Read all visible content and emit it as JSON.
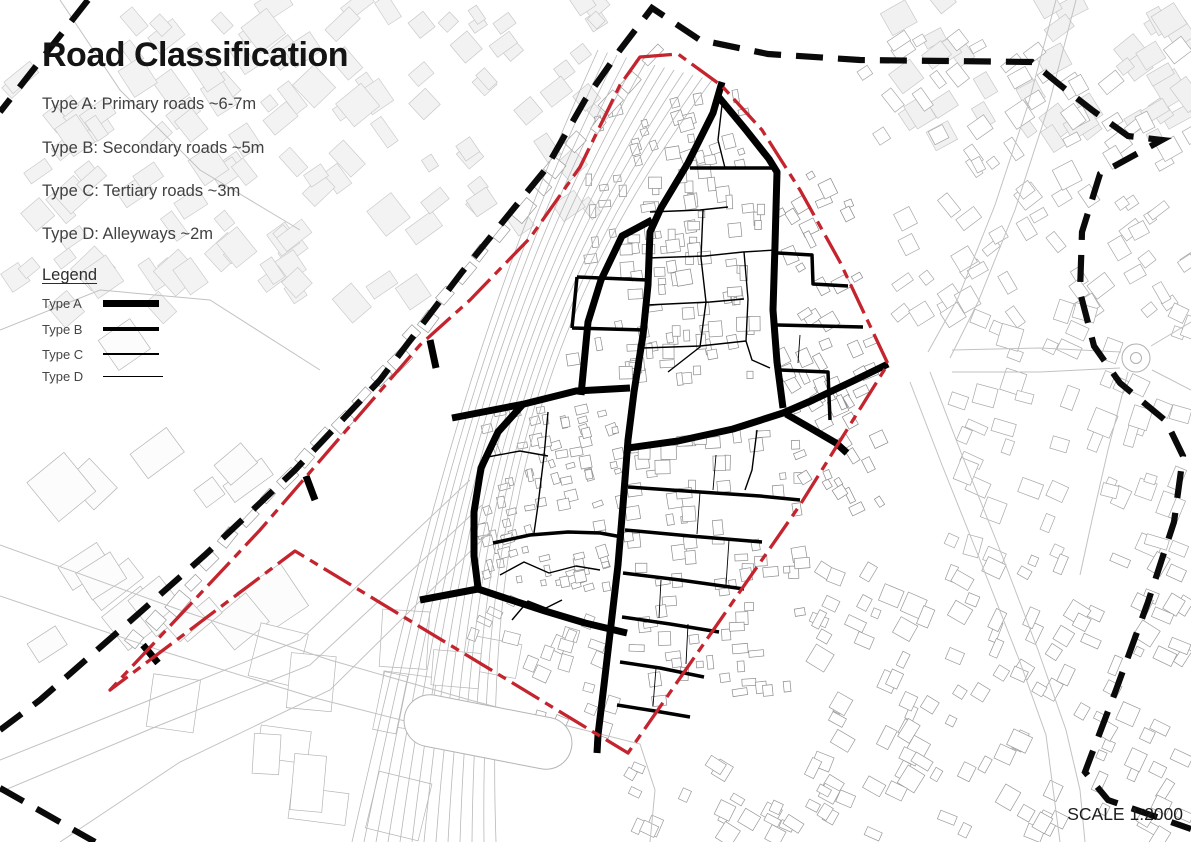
{
  "header": {
    "title": "Road Classification"
  },
  "classification": {
    "items": [
      {
        "label": "Type A: Primary roads ~6-7m"
      },
      {
        "label": "Type B: Secondary roads ~5m"
      },
      {
        "label": "Type C: Tertiary roads ~3m"
      },
      {
        "label": "Type D: Alleyways ~2m"
      }
    ]
  },
  "legend": {
    "title": "Legend",
    "items": [
      {
        "label": "Type A",
        "class": "lw-a"
      },
      {
        "label": "Type B",
        "class": "lw-b"
      },
      {
        "label": "Type C",
        "class": "lw-c"
      },
      {
        "label": "Type D",
        "class": "lw-d"
      }
    ]
  },
  "scale_note": "SCALE 1:2000",
  "colors": {
    "site_boundary_red": "#c4242d",
    "outer_boundary_black": "#0a0a0a",
    "road_black": "#000000",
    "building_stroke": "#a0a0a0",
    "building_light_fill": "#f2f2f2",
    "rail_gray": "#b8b8b8",
    "street_gray": "#c2c2c2"
  },
  "map": {
    "width": 1191,
    "height": 842,
    "site_boundary": {
      "style": "dash-dot",
      "width": 3.3,
      "dash": "32 7 9 7",
      "points": [
        640,
        57,
        678,
        54,
        722,
        86,
        762,
        130,
        800,
        190,
        840,
        262,
        888,
        364,
        800,
        505,
        628,
        753,
        295,
        551,
        110,
        690,
        260,
        530,
        420,
        345,
        470,
        300,
        530,
        238,
        580,
        167,
        620,
        85
      ]
    },
    "outer_boundary": {
      "style": "dashed",
      "width": 6.2,
      "dash": "27 15",
      "segments": [
        [
          88,
          0,
          0,
          112
        ],
        [
          0,
          730,
          40,
          700,
          120,
          630,
          205,
          555,
          295,
          470,
          380,
          380,
          462,
          272,
          545,
          170,
          585,
          100,
          620,
          50,
          652,
          8,
          700,
          40,
          768,
          54,
          860,
          60,
          1032,
          62,
          1060,
          85,
          1092,
          110,
          1128,
          136,
          1162,
          140,
          1100,
          174,
          1082,
          232,
          1080,
          292,
          1094,
          346,
          1120,
          383,
          1166,
          421,
          1183,
          456,
          1174,
          522,
          1148,
          602,
          1116,
          690,
          1085,
          772,
          1108,
          800,
          1191,
          829
        ],
        [
          0,
          788,
          95,
          842
        ]
      ]
    },
    "roads": {
      "A": {
        "width": 7,
        "lines": [
          [
            722,
            82,
            713,
            113,
            688,
            163,
            661,
            208,
            650,
            232,
            648,
            285,
            643,
            335,
            634,
            392,
            628,
            440,
            623,
            505,
            618,
            565,
            611,
            625,
            604,
            685,
            598,
            735,
            597,
            753
          ],
          [
            652,
            220,
            622,
            236,
            601,
            280,
            588,
            322,
            581,
            395
          ],
          [
            452,
            418,
            524,
            404,
            576,
            391,
            630,
            388
          ],
          [
            524,
            403,
            498,
            432,
            481,
            468,
            474,
            512,
            474,
            556,
            478,
            588
          ],
          [
            420,
            600,
            478,
            589,
            505,
            598,
            545,
            611,
            585,
            623,
            627,
            633
          ],
          [
            717,
            95,
            746,
            130,
            769,
            159,
            777,
            172,
            775,
            245,
            773,
            310,
            777,
            362,
            783,
            408
          ],
          [
            888,
            364,
            853,
            381,
            813,
            400,
            783,
            413,
            733,
            429,
            678,
            441,
            628,
            448
          ],
          [
            786,
            414,
            812,
            429,
            836,
            443,
            847,
            453
          ],
          [
            430,
            340,
            436,
            368
          ],
          [
            306,
            476,
            315,
            500
          ],
          [
            143,
            645,
            158,
            663
          ]
        ]
      },
      "B": {
        "width": 3.5,
        "lines": [
          [
            690,
            168,
            777,
            168
          ],
          [
            577,
            277,
            648,
            280
          ],
          [
            572,
            328,
            645,
            330
          ],
          [
            577,
            277,
            572,
            328
          ],
          [
            778,
            253,
            812,
            255,
            813,
            284,
            848,
            286
          ],
          [
            777,
            325,
            863,
            327
          ],
          [
            780,
            370,
            828,
            372,
            830,
            420
          ],
          [
            628,
            487,
            700,
            492,
            760,
            496,
            800,
            500
          ],
          [
            625,
            530,
            690,
            536,
            762,
            542
          ],
          [
            623,
            573,
            680,
            580,
            744,
            589
          ],
          [
            622,
            617,
            670,
            624,
            719,
            632
          ],
          [
            620,
            662,
            660,
            668,
            704,
            677
          ],
          [
            617,
            705,
            655,
            711,
            690,
            717
          ],
          [
            493,
            543,
            530,
            535,
            568,
            532,
            600,
            533,
            622,
            537
          ]
        ]
      },
      "C": {
        "width": 1.4,
        "lines": [
          [
            650,
            212,
            700,
            210,
            728,
            207
          ],
          [
            648,
            258,
            705,
            256,
            743,
            252,
            776,
            250
          ],
          [
            647,
            305,
            710,
            302,
            744,
            299
          ],
          [
            643,
            348,
            700,
            346,
            746,
            341
          ],
          [
            703,
            210,
            701,
            258,
            706,
            302,
            700,
            347,
            668,
            372
          ],
          [
            744,
            252,
            748,
            299,
            746,
            341,
            752,
            360,
            770,
            368
          ],
          [
            482,
            458,
            520,
            451,
            548,
            456
          ],
          [
            548,
            412,
            544,
            456,
            538,
            505,
            534,
            533
          ],
          [
            500,
            575,
            524,
            562,
            549,
            573,
            576,
            566,
            600,
            570
          ],
          [
            512,
            620,
            528,
            601,
            546,
            608,
            562,
            600
          ],
          [
            757,
            430,
            752,
            470,
            745,
            490
          ],
          [
            722,
            105,
            718,
            140,
            725,
            168
          ]
        ]
      },
      "D": {
        "width": 0.9,
        "lines": [
          [
            700,
            492,
            697,
            534
          ],
          [
            729,
            540,
            726,
            585
          ],
          [
            661,
            580,
            659,
            618
          ],
          [
            688,
            624,
            686,
            664
          ],
          [
            716,
            455,
            713,
            490
          ],
          [
            656,
            668,
            653,
            706
          ],
          [
            800,
            335,
            798,
            363
          ]
        ]
      }
    },
    "railway": {
      "count": 13,
      "x0": 598,
      "y0": 50,
      "dx": 9.5,
      "dy": 2.5,
      "c1x": 480,
      "c1y": 310,
      "c2x": 425,
      "c2y": 520,
      "bx": 352,
      "by": 842,
      "bdx": 12
    },
    "gray_lines": [
      [
        470,
        480,
        300,
        640,
        150,
        700,
        0,
        760
      ],
      [
        482,
        505,
        310,
        665,
        160,
        725,
        0,
        792
      ],
      [
        492,
        530,
        330,
        690,
        180,
        762,
        60,
        842
      ],
      [
        0,
        545,
        180,
        610,
        330,
        660,
        470,
        700,
        560,
        724,
        640,
        744,
        655,
        790,
        650,
        842
      ],
      [
        0,
        596,
        165,
        652,
        315,
        698,
        448,
        732,
        520,
        748
      ],
      [
        1056,
        0,
        1028,
        105,
        995,
        205,
        958,
        298,
        928,
        352
      ],
      [
        1076,
        0,
        1048,
        108,
        1015,
        210,
        978,
        302,
        950,
        358
      ],
      [
        930,
        372,
        962,
        455,
        998,
        545,
        1038,
        650,
        1066,
        730,
        1080,
        790,
        1085,
        842
      ],
      [
        910,
        382,
        942,
        465,
        978,
        555,
        1020,
        662,
        1046,
        735,
        1060,
        842
      ],
      [
        952,
        350,
        1040,
        348,
        1121,
        352
      ],
      [
        952,
        372,
        1040,
        372,
        1120,
        368
      ],
      [
        1151,
        346,
        1191,
        322
      ],
      [
        1152,
        370,
        1191,
        390
      ],
      [
        1128,
        372,
        1108,
        450,
        1092,
        520,
        1080,
        575
      ],
      [
        60,
        0,
        120,
        90,
        200,
        170,
        300,
        230
      ],
      [
        0,
        330,
        100,
        290,
        210,
        300,
        320,
        370
      ]
    ],
    "stadium": {
      "cx": 488,
      "cy": 732,
      "w": 170,
      "h": 52,
      "rx": 26,
      "rot": 11
    },
    "roundabout": {
      "cx": 1136,
      "cy": 358,
      "r1": 14,
      "r2": 5.5
    },
    "clusters": [
      {
        "x": 0,
        "y": 0,
        "w": 430,
        "h": 310,
        "rot": -38,
        "n": 95,
        "s": 24,
        "f": "#f3f3f3",
        "st": "#cccccc",
        "seed": 11
      },
      {
        "x": 420,
        "y": 0,
        "w": 190,
        "h": 225,
        "rot": -38,
        "n": 34,
        "s": 19,
        "f": "#f2f2f2",
        "st": "#c9c9c9",
        "seed": 22
      },
      {
        "x": 880,
        "y": 0,
        "w": 311,
        "h": 140,
        "rot": -33,
        "n": 42,
        "s": 22,
        "f": "#f1f1f1",
        "st": "#c8c8c8",
        "seed": 33
      },
      {
        "x": 860,
        "y": 40,
        "w": 331,
        "h": 280,
        "rot": -33,
        "n": 85,
        "s": 16,
        "f": "#ffffff",
        "st": "#a8a8a8",
        "seed": 44
      },
      {
        "x": 950,
        "y": 310,
        "w": 241,
        "h": 250,
        "rot": 20,
        "n": 55,
        "s": 17,
        "f": "#ffffff",
        "st": "#a8a8a8",
        "seed": 55
      },
      {
        "x": 810,
        "y": 560,
        "w": 381,
        "h": 282,
        "rot": 27,
        "n": 120,
        "s": 15,
        "f": "#ffffff",
        "st": "#9a9a9a",
        "seed": 66
      },
      {
        "x": 630,
        "y": 755,
        "w": 210,
        "h": 87,
        "rot": 27,
        "n": 26,
        "s": 14,
        "f": "#ffffff",
        "st": "#9a9a9a",
        "seed": 77
      },
      {
        "x": 30,
        "y": 330,
        "w": 280,
        "h": 330,
        "rot": -38,
        "n": 17,
        "s": 40,
        "f": "#fcfcfc",
        "st": "#b5b5b5",
        "seed": 88
      },
      {
        "x": 170,
        "y": 620,
        "w": 370,
        "h": 190,
        "rot": 8,
        "n": 13,
        "s": 42,
        "f": "#ffffff",
        "st": "#b5b5b5",
        "seed": 99
      },
      {
        "x": 595,
        "y": 95,
        "w": 165,
        "h": 72,
        "rot": -14,
        "n": 26,
        "s": 11,
        "f": "#ffffff",
        "st": "#8c8c8c",
        "seed": 101
      },
      {
        "x": 585,
        "y": 170,
        "w": 180,
        "h": 135,
        "rot": -4,
        "n": 60,
        "s": 11,
        "f": "#ffffff",
        "st": "#8c8c8c",
        "seed": 102
      },
      {
        "x": 565,
        "y": 308,
        "w": 200,
        "h": 72,
        "rot": -6,
        "n": 34,
        "s": 11,
        "f": "#ffffff",
        "st": "#8c8c8c",
        "seed": 103
      },
      {
        "x": 778,
        "y": 175,
        "w": 95,
        "h": 235,
        "rot": -27,
        "n": 38,
        "s": 12,
        "f": "#ffffff",
        "st": "#8c8c8c",
        "seed": 104
      },
      {
        "x": 478,
        "y": 408,
        "w": 142,
        "h": 180,
        "rot": -15,
        "n": 85,
        "s": 9,
        "f": "#ffffff",
        "st": "#8c8c8c",
        "seed": 105
      },
      {
        "x": 628,
        "y": 432,
        "w": 175,
        "h": 275,
        "rot": -4,
        "n": 80,
        "s": 11,
        "f": "#ffffff",
        "st": "#8c8c8c",
        "seed": 106
      },
      {
        "x": 795,
        "y": 398,
        "w": 85,
        "h": 115,
        "rot": -28,
        "n": 18,
        "s": 11,
        "f": "#ffffff",
        "st": "#8c8c8c",
        "seed": 107
      },
      {
        "x": 468,
        "y": 598,
        "w": 145,
        "h": 135,
        "rot": -70,
        "n": 24,
        "s": 12,
        "f": "#ffffff",
        "st": "#9a9a9a",
        "seed": 108
      },
      {
        "row": true,
        "x1": 138,
        "y1": 640,
        "x2": 415,
        "y2": 338,
        "n": 16,
        "s": 13,
        "st": "#9a9a9a",
        "seed": 109
      },
      {
        "row": true,
        "x1": 428,
        "y1": 318,
        "x2": 650,
        "y2": 58,
        "n": 13,
        "s": 13,
        "st": "#9a9a9a",
        "seed": 110
      }
    ]
  }
}
